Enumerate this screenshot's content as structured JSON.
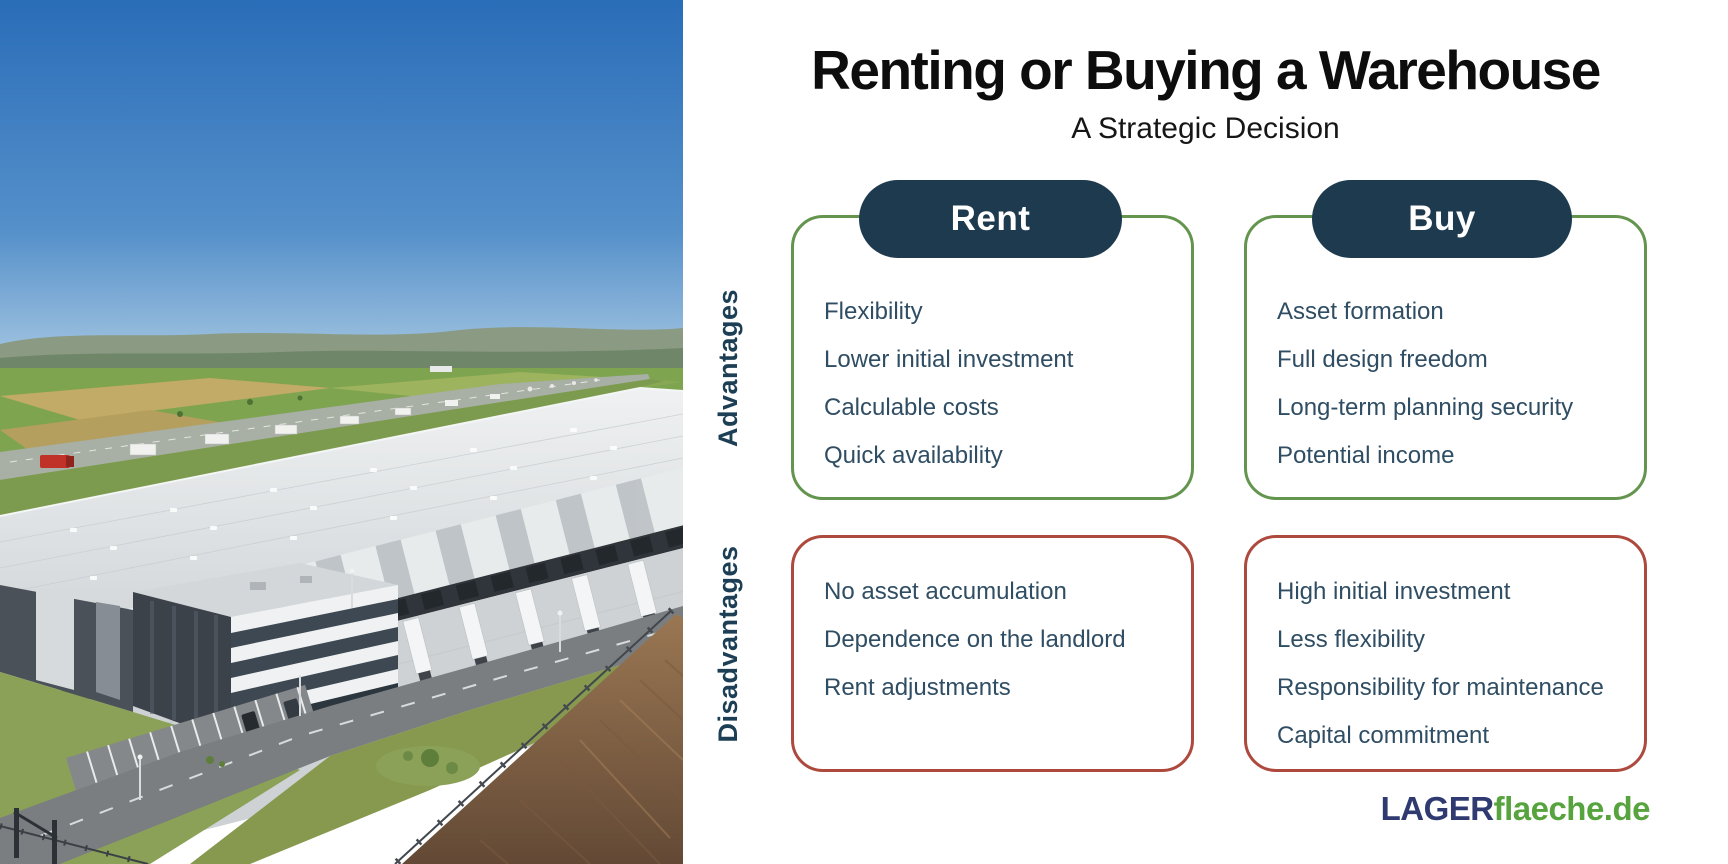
{
  "header": {
    "title": "Renting or Buying a Warehouse",
    "subtitle": "A Strategic Decision"
  },
  "rows": {
    "advantages_label": "Advantages",
    "disadvantages_label": "Disadvantages"
  },
  "columns": [
    {
      "label": "Rent",
      "advantages": [
        "Flexibility",
        "Lower initial investment",
        "Calculable costs",
        "Quick availability"
      ],
      "disadvantages": [
        "No asset accumulation",
        "Dependence on the landlord",
        "Rent adjustments"
      ]
    },
    {
      "label": "Buy",
      "advantages": [
        "Asset formation",
        "Full design freedom",
        "Long-term planning security",
        "Potential income"
      ],
      "disadvantages": [
        "High initial investment",
        "Less flexibility",
        "Responsibility for maintenance",
        "Capital commitment"
      ]
    }
  ],
  "logo": {
    "part1": "LAGER",
    "part2": "flaeche.de"
  },
  "photo": {
    "alt": "Aerial view of a modern logistics warehouse complex with loading docks, trucks, an office building, parking lot, motorway and a plowed field"
  },
  "colors": {
    "pill_navy": "#1d3a4e",
    "advantage_green": "#64954e",
    "disadvantage_red": "#ad4a3d",
    "body_text": "#2f4d63",
    "row_label_navy": "#1c3f55",
    "logo_navy": "#2e3a70",
    "logo_green": "#57a33e"
  }
}
